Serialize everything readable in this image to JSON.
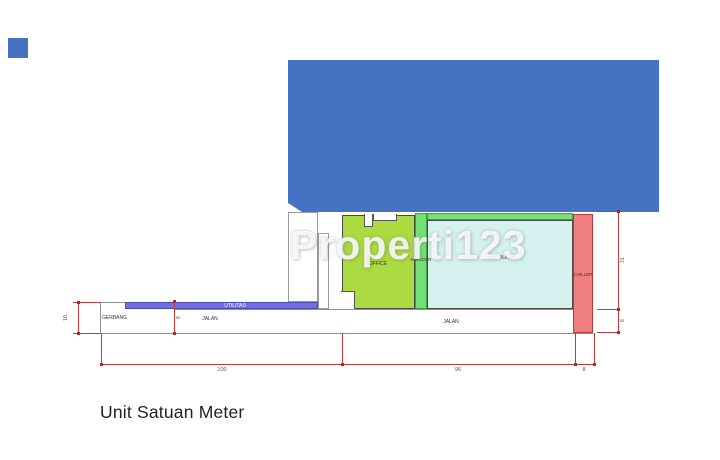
{
  "watermark": "Properti123",
  "caption": "Unit Satuan Meter",
  "plan": {
    "labels": {
      "office": "OFFICE",
      "koridor": "KORIDOR",
      "produksi": "PRODUKSI",
      "chiller": "CHILLER",
      "utilitas": "UTILITAS",
      "gerbang": "GERBANG",
      "jalan_left": "JALAN",
      "jalan_right": "JALAN"
    },
    "dimensions": {
      "bottom_seg1": "100",
      "bottom_seg2": "96",
      "bottom_seg3": "8",
      "left": "10",
      "inner": "8",
      "right_top": "31",
      "right_bottom": "8"
    },
    "unit": "meter"
  },
  "colors": {
    "building_blue": "#4672c4",
    "office_green": "#abdb40",
    "koridor_green": "#74df74",
    "produksi_cyan": "#d5f2f0",
    "chiller_salmon": "#f08080",
    "utilitas_violet": "#6f6fe0",
    "dimension_red": "#c23a3a"
  }
}
